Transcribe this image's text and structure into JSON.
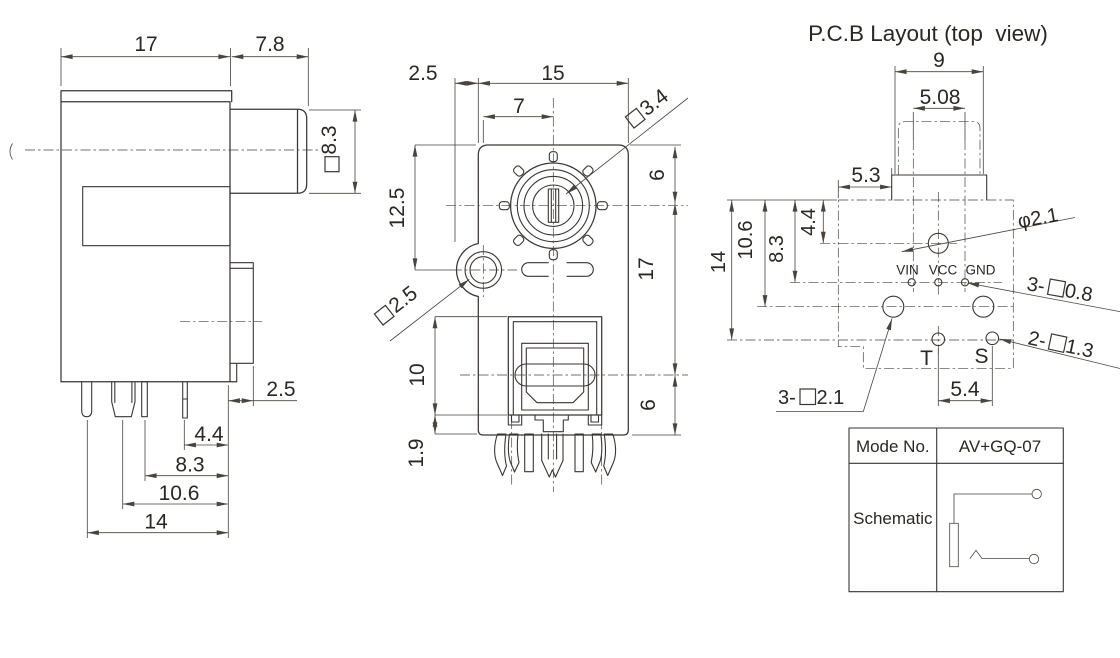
{
  "side_view": {
    "dim_body_width": "17",
    "dim_barrel_length": "7.8",
    "dim_barrel_square": "8.3",
    "dim_step": "2.5",
    "dim_pin_4_4": "4.4",
    "dim_pin_8_3": "8.3",
    "dim_pin_10_6": "10.6",
    "dim_pin_14": "14"
  },
  "front_view": {
    "dim_offset": "2.5",
    "dim_width": "15",
    "dim_center": "7",
    "dim_slot_square": "3.4",
    "dim_hole_square": "2.5",
    "dim_left_height": "12.5",
    "dim_right_top": "6",
    "dim_right_mid": "17",
    "dim_right_bottom": "6",
    "dim_optical_height": "10",
    "dim_pin_exposed": "1.9"
  },
  "pcb": {
    "title": "P.C.B Layout (top  view)",
    "dim_tab_width": "9",
    "dim_pin_pitch": "5.08",
    "dim_tab_offset": "5.3",
    "dim_row_4_4": "4.4",
    "dim_row_8_3": "8.3",
    "dim_row_10_6": "10.6",
    "dim_row_14": "14",
    "dim_ts_pitch": "5.4",
    "hole_dia_label": "φ2.1",
    "leader_small_holes": {
      "prefix": "3-",
      "value": "0.8"
    },
    "leader_ts_holes": {
      "prefix": "2-",
      "value": "1.3"
    },
    "leader_big_holes": {
      "prefix": "3-",
      "value": "2.1"
    },
    "pads": {
      "vin": "VIN",
      "vcc": "VCC",
      "gnd": "GND",
      "t": "T",
      "s": "S"
    }
  },
  "table": {
    "mode_label": "Mode No.",
    "mode_value": "AV+GQ-07",
    "schematic_label": "Schematic"
  }
}
